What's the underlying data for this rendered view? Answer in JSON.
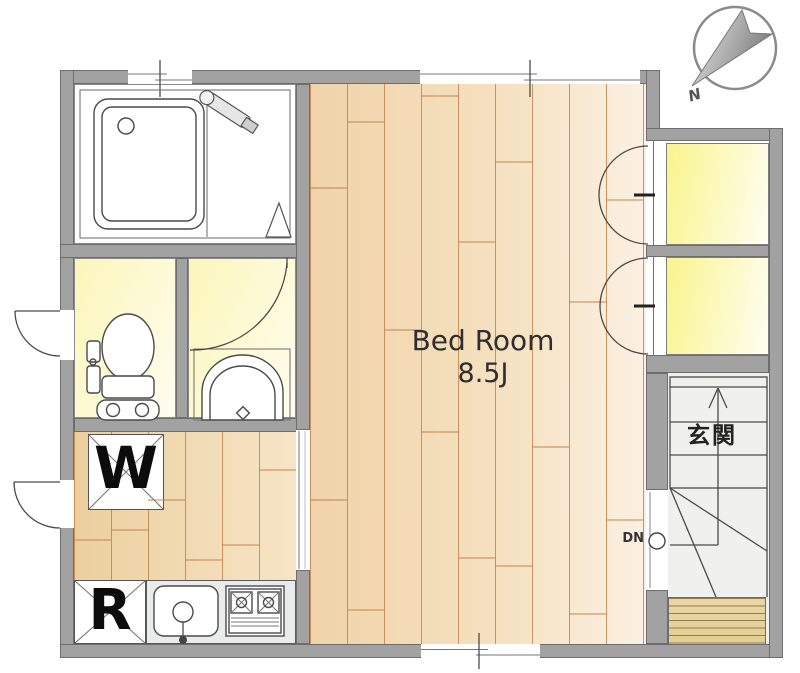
{
  "labels": {
    "bedroom_name": "Bed Room",
    "bedroom_size": "8.5J",
    "entrance": "玄関",
    "stairs_down_label": "DN",
    "washing_machine_symbol": "W",
    "refrigerator_symbol": "R",
    "compass_north": "N"
  },
  "colors": {
    "wall": "#a2a2a2",
    "wall_edge": "#6d6d6d",
    "wood_dark": "#eccf9f",
    "wood_light": "#fbf0e2",
    "plank_line": "#c6824a",
    "wet_room_yellow": "#fbf6b9",
    "closet_yellow": "#f9f48c",
    "step_tan": "#ead7a6",
    "counter_gray": "#e9eceb",
    "line_dark": "#4a4a4a"
  }
}
